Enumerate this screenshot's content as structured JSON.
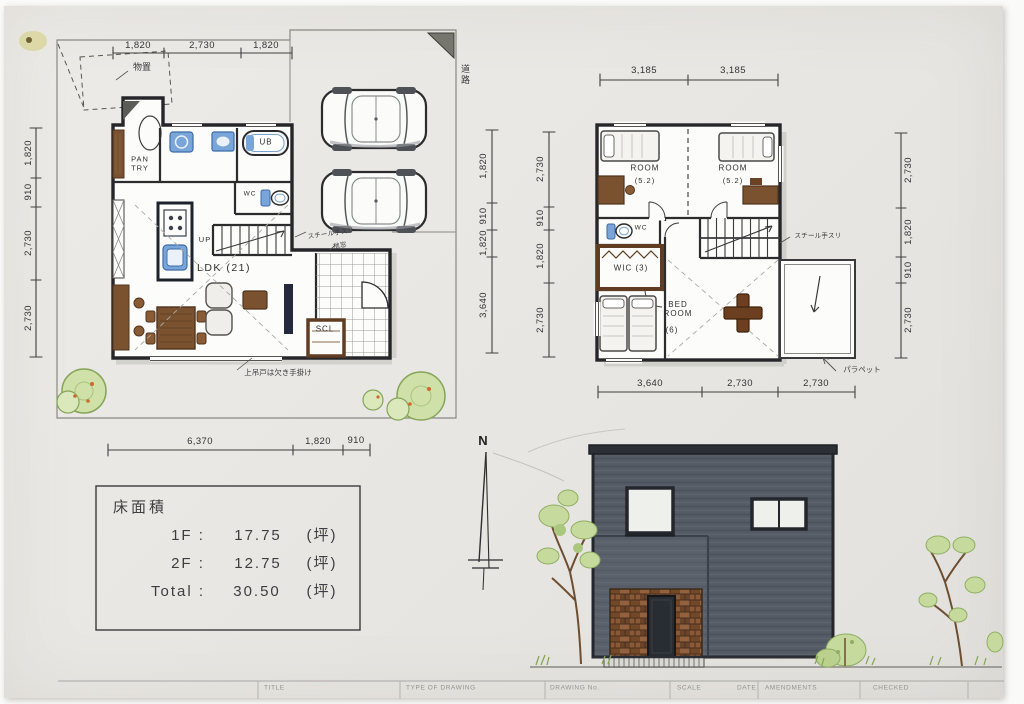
{
  "f1": {
    "dims_top": [
      "1,820",
      "2,730",
      "1,820"
    ],
    "dims_left": [
      "1,820",
      "910",
      "2,730",
      "2,730"
    ],
    "dims_right": [
      "1,820",
      "910",
      "1,820",
      "3,640"
    ],
    "dims_bottom": [
      "6,370",
      "1,820",
      "910"
    ],
    "storage": "物置",
    "road": "道路",
    "pantry": "PAN TRY",
    "ub": "UB",
    "wc": "WC",
    "up": "UP",
    "ldk": "LDK (21)",
    "scl": "SCL",
    "note_rail": "スチール手スリ",
    "note_window": "地窓",
    "note_door": "上吊戸は欠き手掛け"
  },
  "f2": {
    "dims_top": [
      "3,185",
      "3,185"
    ],
    "dims_left": [
      "2,730",
      "910",
      "1,820",
      "2,730"
    ],
    "dims_right": [
      "2,730",
      "1,820",
      "910",
      "2,730"
    ],
    "dims_bottom": [
      "3,640",
      "2,730",
      "2,730"
    ],
    "room_l": "ROOM",
    "room_l_size": "(5.2)",
    "room_r": "ROOM",
    "room_r_size": "(5.2)",
    "wc": "WC",
    "wic": "WIC (3)",
    "bedroom": "BED ROOM",
    "bedroom_size": "(6)",
    "note_rail": "スチール手スリ",
    "note_parapet": "パラペット"
  },
  "area": {
    "title": "床面積",
    "rows": [
      {
        "label": "1F :",
        "value": "17.75",
        "unit": "(坪)"
      },
      {
        "label": "2F :",
        "value": "12.75",
        "unit": "(坪)"
      },
      {
        "label": "Total :",
        "value": "30.50",
        "unit": "(坪)"
      }
    ]
  },
  "north": "N",
  "titleblock": [
    "TITLE",
    "TYPE OF DRAWING",
    "DRAWING No.",
    "SCALE",
    "DATE",
    "AMENDMENTS",
    "CHECKED"
  ],
  "colors": {
    "wall": "#26262a",
    "fixture_blue": "#79a5d9",
    "wood_brown": "#7a5230",
    "facade_gray": "#565c66",
    "brick": "#7d5334",
    "foliage_green": "#c6da9e"
  }
}
